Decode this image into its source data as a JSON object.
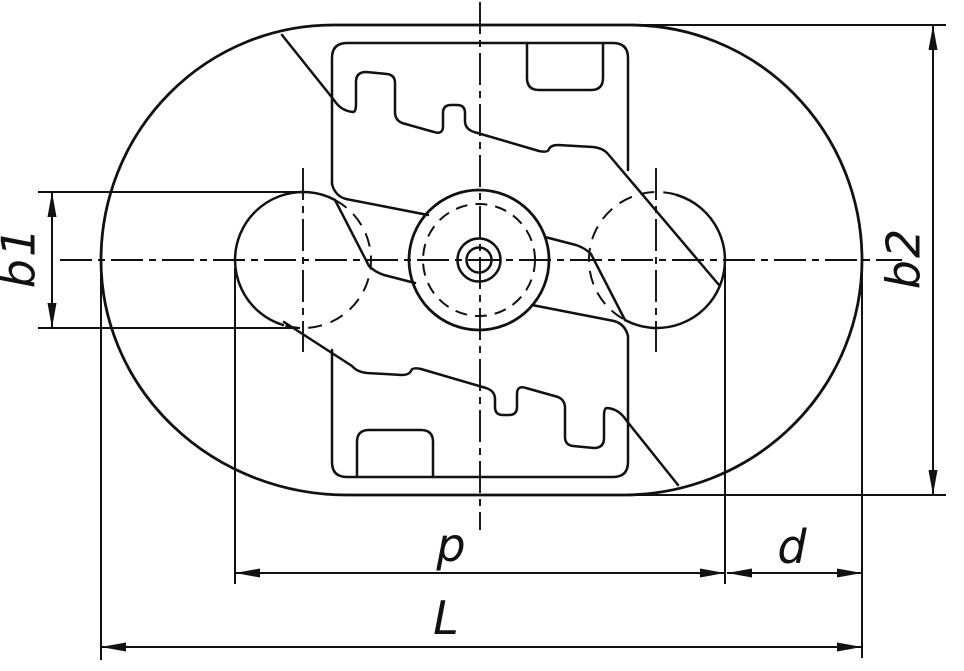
{
  "drawing": {
    "kind": "engineering-line-drawing",
    "subject": "track link / crawler shoe plan view with zigzag tread band, two pin bores and central hub",
    "background_color": "#ffffff",
    "line_color": "#111111",
    "line_styles": {
      "visible_outline": "solid thick",
      "hidden_edges": "dashed",
      "centerlines": "dash-dot",
      "dimensions": "thin solid with filled arrowheads"
    }
  },
  "dimension_labels": {
    "b1": "b1",
    "b2": "b2",
    "p": "p",
    "d": "d",
    "L": "L"
  },
  "dimensions_meta": [
    {
      "id": "b1",
      "orientation": "vertical",
      "location": "left side, across pin-bore diameter"
    },
    {
      "id": "b2",
      "orientation": "vertical",
      "location": "right side, overall height"
    },
    {
      "id": "p",
      "orientation": "horizontal",
      "location": "below view, across both pin bores"
    },
    {
      "id": "d",
      "orientation": "horizontal",
      "location": "below view right, bore edge to shoe end"
    },
    {
      "id": "L",
      "orientation": "horizontal",
      "location": "bottom, overall length"
    }
  ]
}
